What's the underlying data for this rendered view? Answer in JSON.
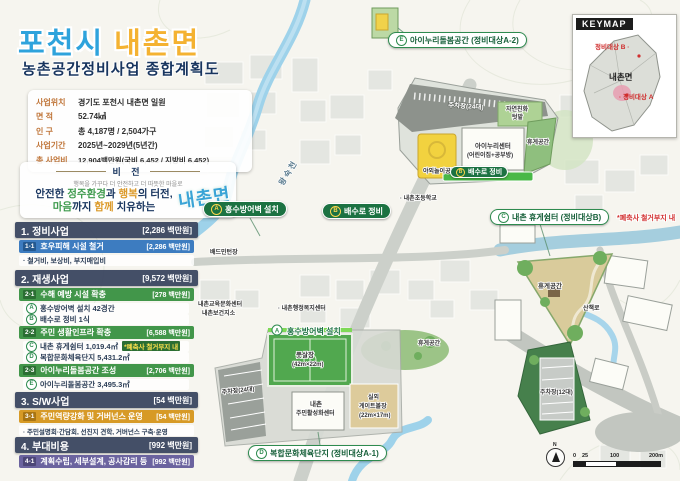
{
  "header": {
    "city": "포천시",
    "myeon": "내촌면",
    "subtitle": "농촌공간정비사업 종합계획도"
  },
  "info": {
    "rows": [
      {
        "label": "사업위치",
        "value": "경기도 포천시 내촌면 일원"
      },
      {
        "label": "면  적",
        "value": "52.74㎢"
      },
      {
        "label": "인  구",
        "value": "총 4,187명 / 2,504가구"
      },
      {
        "label": "사업기간",
        "value": "2025년~2029년(5년간)"
      },
      {
        "label": "총 사업비",
        "value": "12,904백만원(국비 6,452 / 지방비 6,452)"
      }
    ]
  },
  "vision": {
    "heading": "비 전",
    "tagline": "행복을 가꾸다 더 안전하고 더 따뜻한 마을로",
    "l1a": "안전한 ",
    "l1b": "정주환경",
    "l1c": "과 ",
    "l1d": "행복",
    "l1e": "의 터전,",
    "l2a": "마음",
    "l2b": "까지 ",
    "l2c": "함께",
    "l2d": " 치유하는",
    "logo": "내촌면"
  },
  "sidebar": {
    "s1": {
      "no": "1. 정비사업",
      "amount": "[2,286 백만원]",
      "sub": {
        "chip": "1-1",
        "label": "호우피해 시설 철거",
        "amount": "[2,286 백만원]"
      },
      "bullet": "· 철거비, 보상비, 부지매입비"
    },
    "s2": {
      "no": "2. 재생사업",
      "amount": "[9,572 백만원]",
      "sub1": {
        "chip": "2-1",
        "label": "수해 예방 시설 확충",
        "amount": "[278 백만원]"
      },
      "itemA": {
        "badge": "A",
        "text": "홍수방어벽 설치 42경간"
      },
      "itemB": {
        "badge": "B",
        "text": "배수로 정비 1식"
      },
      "sub2": {
        "chip": "2-2",
        "label": "주민 생활인프라 확충",
        "amount": "[6,588 백만원]"
      },
      "itemC": {
        "badge": "C",
        "text": "내촌 휴게쉼터 1,019.4㎡",
        "note": "*폐축사 철거부지 내"
      },
      "itemD": {
        "badge": "D",
        "text": "복합문화체육단지 5,431.2㎡"
      },
      "sub3": {
        "chip": "2-3",
        "label": "아이누리돌봄공간 조성",
        "amount": "[2,706 백만원]"
      },
      "itemE": {
        "badge": "E",
        "text": "아이누리돌봄공간 3,495.3㎡"
      }
    },
    "s3": {
      "no": "3. S/W사업",
      "amount": "[54 백만원]",
      "sub": {
        "chip": "3-1",
        "label": "주민역량강화 및 거버넌스 운영",
        "amount": "[54 백만원]"
      },
      "bullet": "· 주민설명회·간담회, 선진지 견학, 거버넌스 구축·운영"
    },
    "s4": {
      "no": "4. 부대비용",
      "amount": "[992 백만원]",
      "sub": {
        "chip": "4-1",
        "label": "계획수립, 세부설계, 공사감리 등",
        "amount": "[992 백만원]"
      }
    }
  },
  "map": {
    "pills": {
      "a": {
        "badge": "A",
        "label": "홍수방어벽 설치"
      },
      "b": {
        "badge": "B",
        "label": "배수로 정비"
      },
      "e": {
        "badge": "E",
        "label": "아이누리돌봄공간 (정비대상A-2)"
      },
      "c": {
        "badge": "C",
        "label": "내촌 휴게쉼터 (정비대상B)",
        "note": "*폐축사 철거부지 내"
      },
      "d": {
        "badge": "D",
        "label": "복합문화체육단지 (정비대상A-1)"
      },
      "drain": {
        "badge": "B",
        "label": "배수로 정비"
      },
      "flood": {
        "badge": "A",
        "label": "홍수방어벽 설치"
      }
    },
    "labels": {
      "river": "왕숙천",
      "badminton": "배드민턴장",
      "school": "· 내촌초등학교",
      "admin": "· 내촌행정복지센터",
      "edu": "내촌교육문화센터",
      "health": "내촌보건지소"
    },
    "inset_e": {
      "parking": "주차장(24대)",
      "garden1": "자연친화",
      "garden2": "텃밭",
      "center1": "아이누리센터",
      "center2": "(어린이집+공부방)",
      "rest": "휴게공간",
      "play": "야외놀이공간"
    },
    "inset_d": {
      "futsal1": "풋살장",
      "futsal2": "(42m×22m)",
      "gate1": "실외",
      "gate2": "게이트볼장",
      "gate3": "(22m×17m)",
      "bld1": "내촌",
      "bld2": "주민활성화센터",
      "parking": "주차장(24대)",
      "rest": "휴게공간"
    },
    "inset_c": {
      "rest": "휴게공간",
      "path": "산책로",
      "parking": "주차장(12대)"
    }
  },
  "keymap": {
    "title": "KEYMAP",
    "target_b": "정비대상 B ·",
    "center": "내촌면",
    "target_a": "· 정비대상 A"
  },
  "scalebar": {
    "n": "N",
    "t0": "0",
    "t25": "25",
    "t100": "100",
    "t200": "200m"
  }
}
